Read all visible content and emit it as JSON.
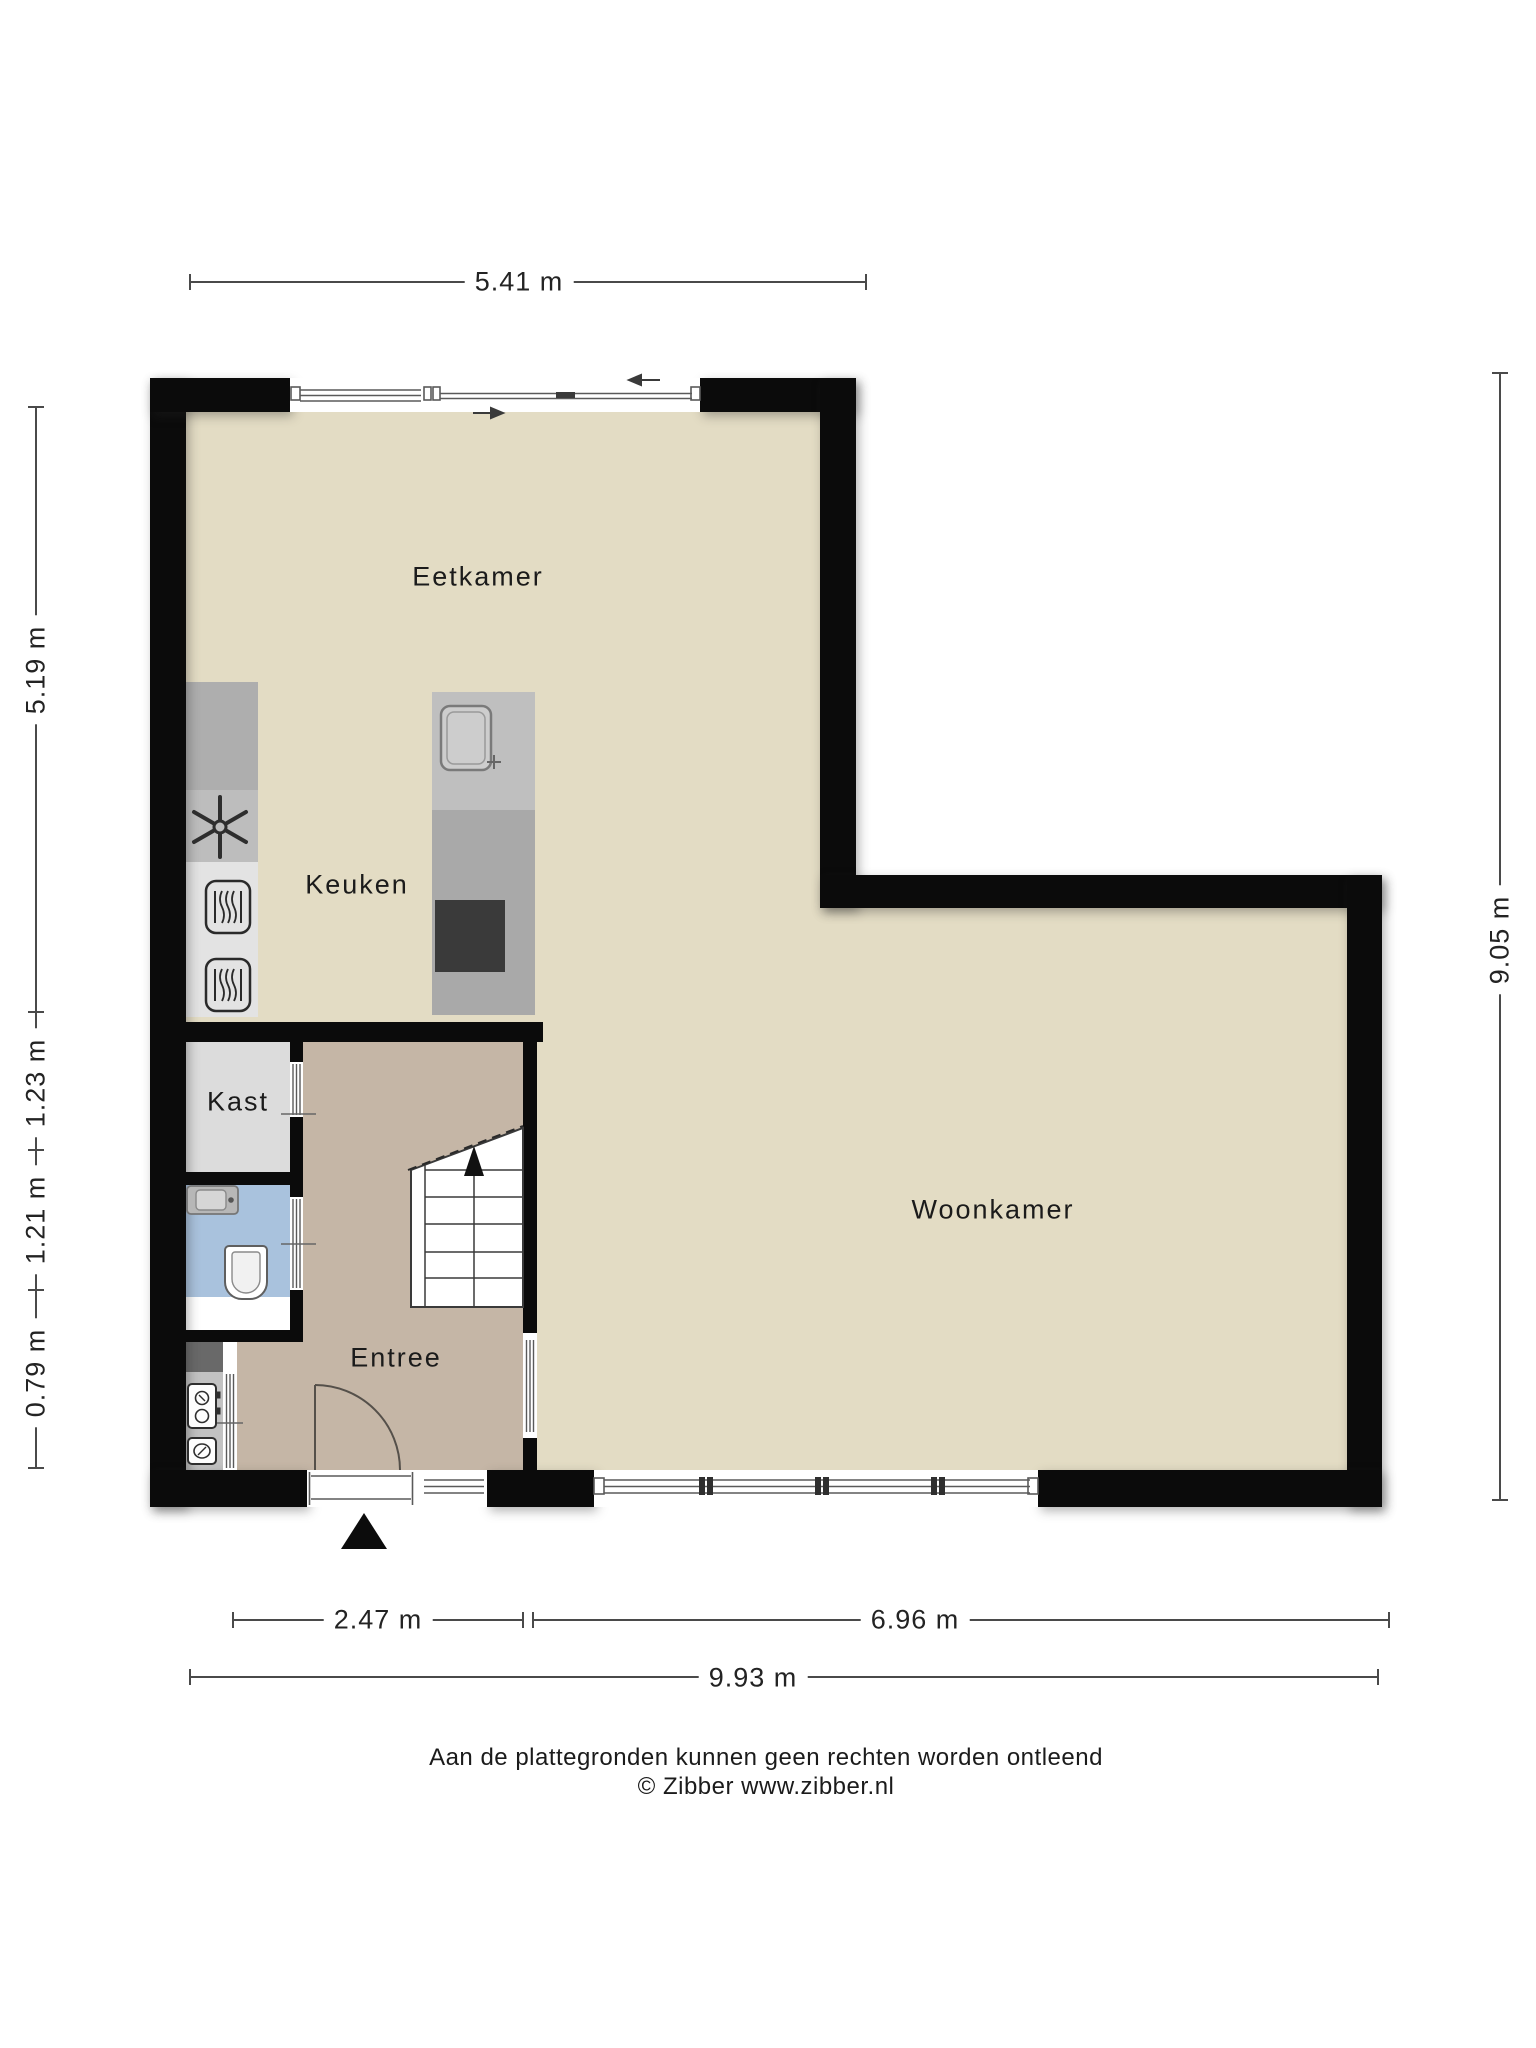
{
  "plan": {
    "rooms": [
      {
        "name": "Eetkamer"
      },
      {
        "name": "Keuken"
      },
      {
        "name": "Kast"
      },
      {
        "name": "Entree"
      },
      {
        "name": "Woonkamer"
      }
    ],
    "dimensions": {
      "top": "5.41 m",
      "right": "9.05 m",
      "left": [
        "5.19 m",
        "1.23 m",
        "1.21 m",
        "0.79 m"
      ],
      "bottom": [
        "2.47 m",
        "6.96 m",
        "9.93 m"
      ]
    },
    "footer": {
      "line1": "Aan de plattegronden kunnen geen rechten worden ontleend",
      "line2": "© Zibber www.zibber.nl"
    },
    "icons": {
      "extractor_fan": "extractor-fan-icon",
      "oven": "oven-icon",
      "sink": "sink-icon",
      "stove": "stove-icon",
      "toilet": "toilet-icon",
      "washbasin": "washbasin-icon",
      "meter": "meter-icon",
      "entrance_marker": "entrance-triangle-icon",
      "stairs": "stairs-icon",
      "slide_left": "arrow-left-icon",
      "slide_right": "arrow-right-icon"
    },
    "colors": {
      "wall": "#0b0b0b",
      "living_floor": "#e3dcc4",
      "hall_floor": "#c5b6a6",
      "closet_floor": "#dcdcdc",
      "toilet_floor": "#a9c2dd",
      "counter_dark": "#aeaeae",
      "counter_light": "#e3e3e3",
      "stove": "#3a3a3a",
      "dimension_line": "#4a4a4a",
      "text": "#1b1b1b"
    }
  }
}
